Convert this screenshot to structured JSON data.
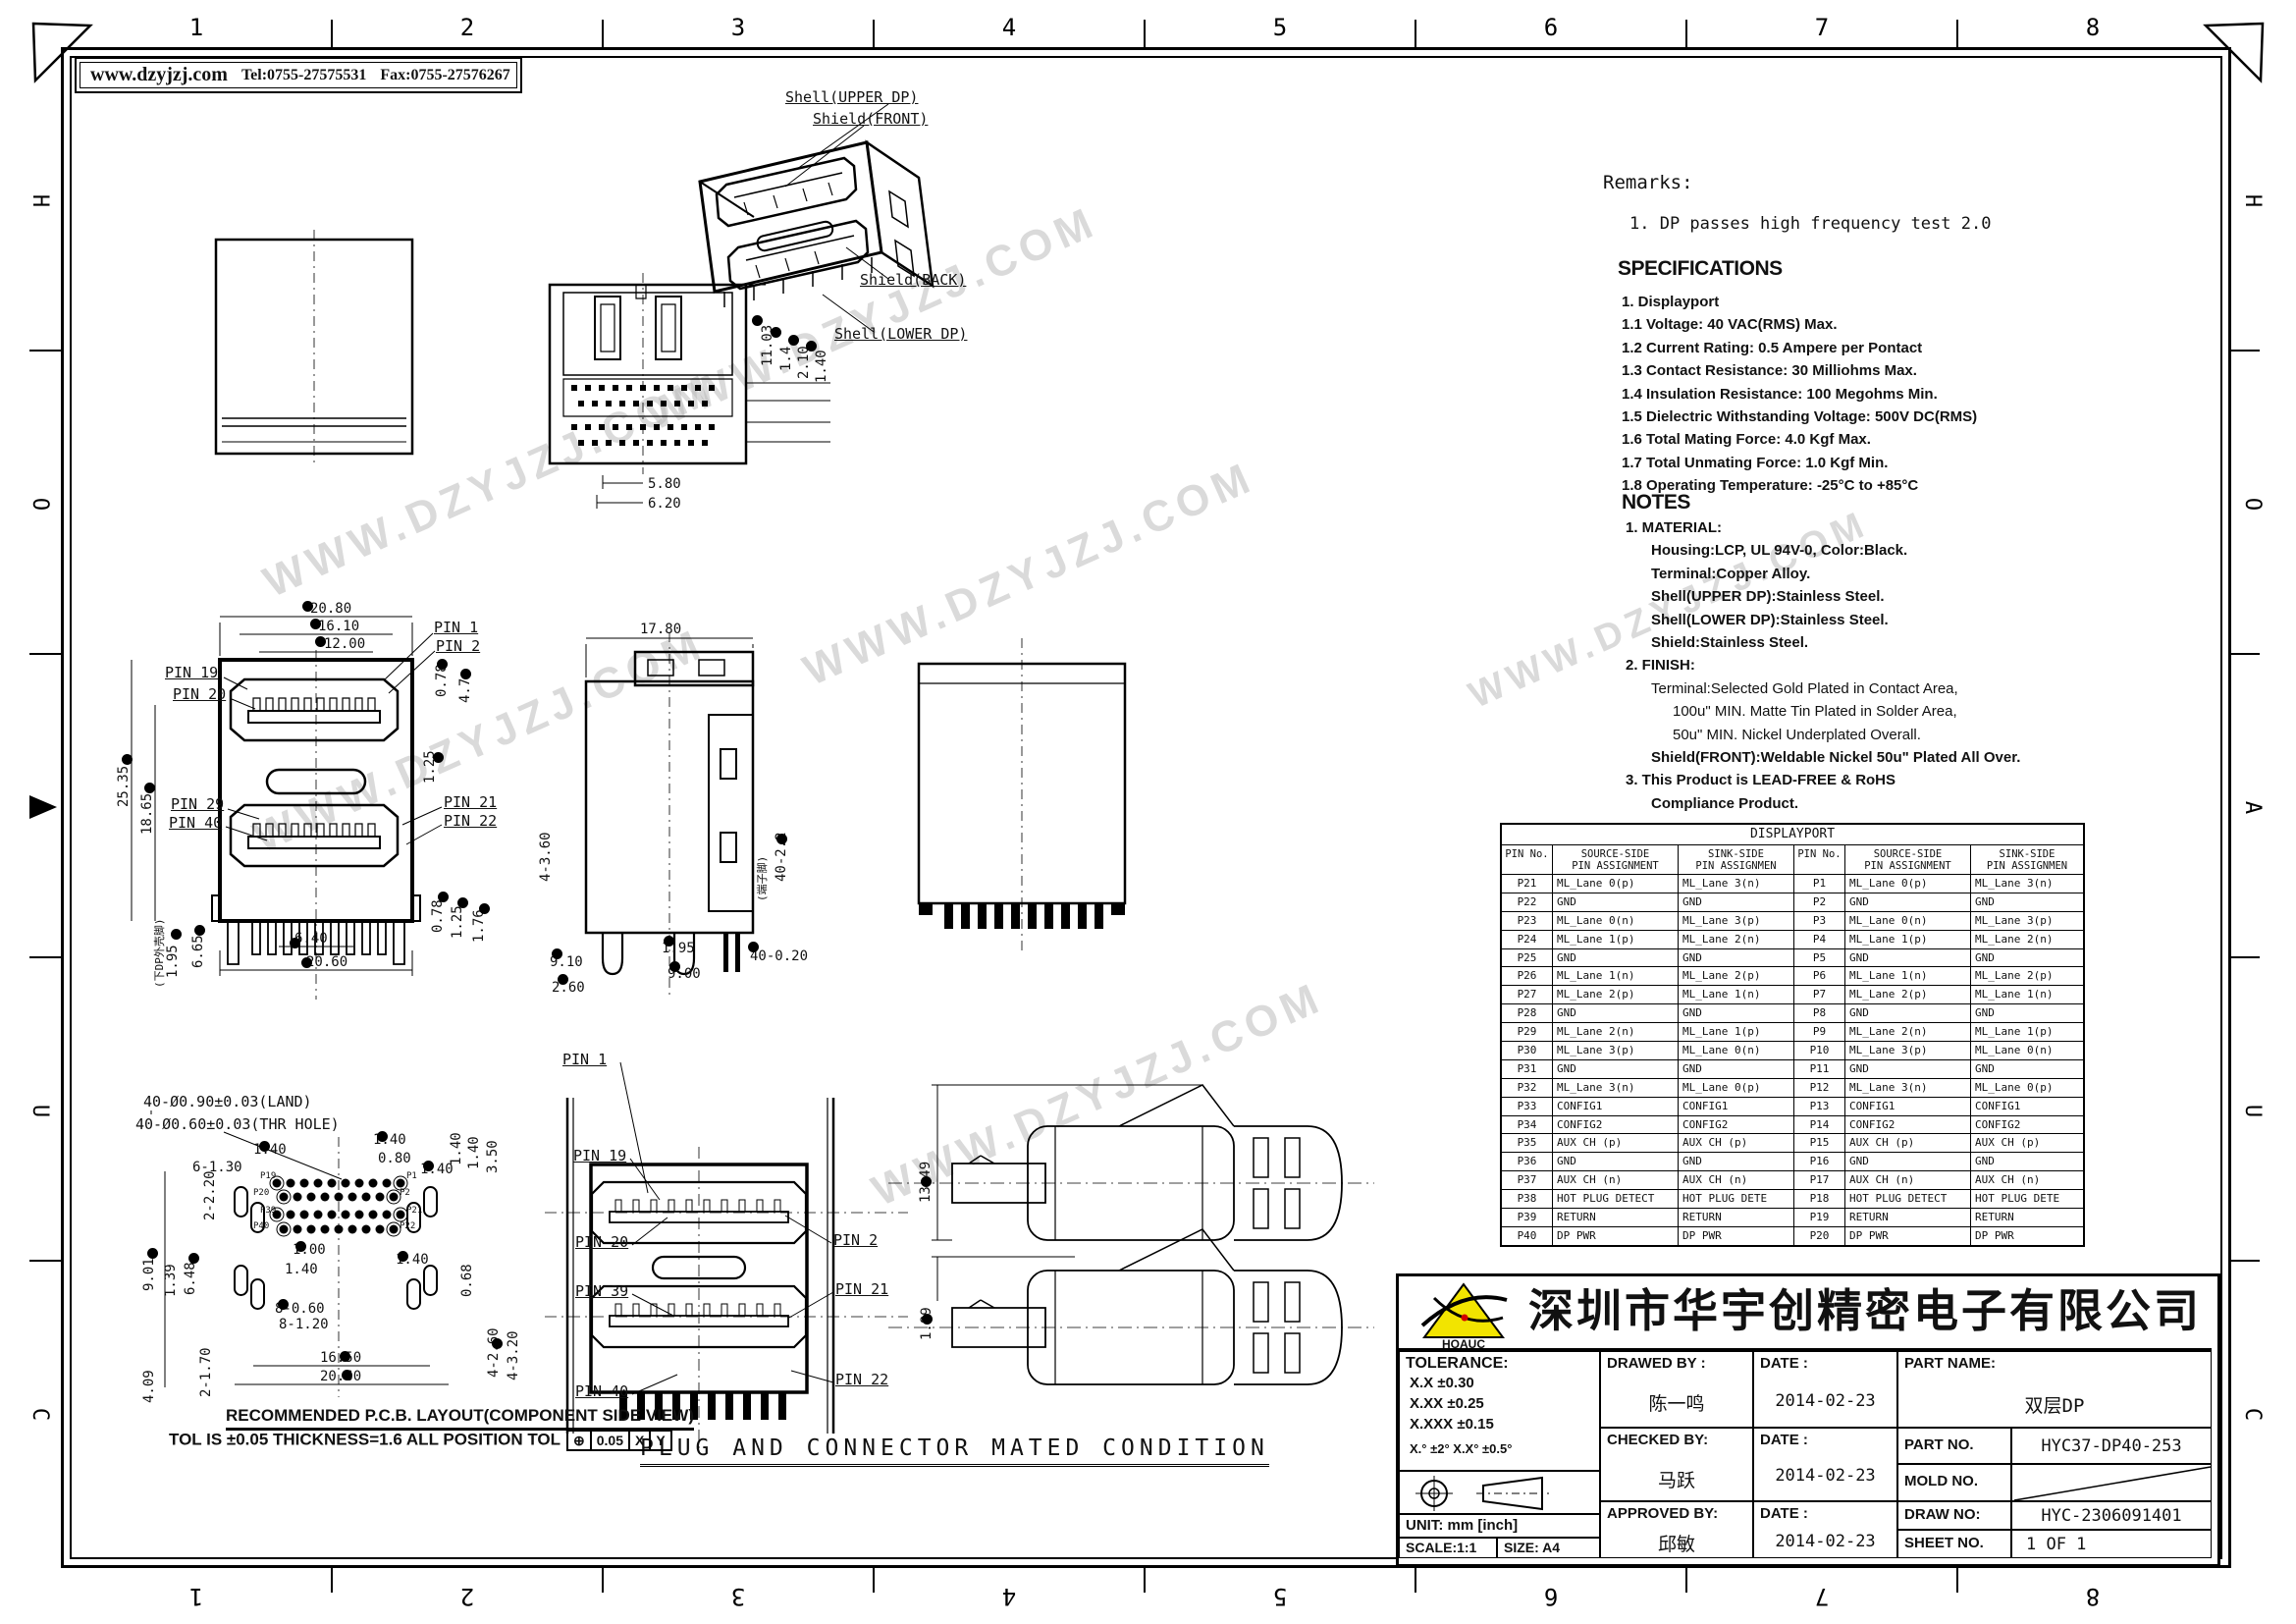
{
  "frame": {
    "cols_top": [
      "1",
      "2",
      "3",
      "4",
      "5",
      "6",
      "7",
      "8"
    ],
    "cols_bottom": [
      "8",
      "7",
      "6",
      "5",
      "4",
      "3",
      "2",
      "1"
    ],
    "rows_left": [
      "H",
      "O",
      "A",
      "U",
      "C"
    ],
    "rows_right": [
      "H",
      "O",
      "A",
      "U",
      "C"
    ]
  },
  "header": {
    "website": "www.dzyjzj.com",
    "tel": "Tel:0755-27575531",
    "fax": "Fax:0755-27576267"
  },
  "watermark": {
    "text": "WWW.DZYJZJ.COM"
  },
  "remarks": {
    "title": "Remarks:",
    "item1": "1. DP passes high frequency test 2.0"
  },
  "specifications": {
    "title": "SPECIFICATIONS",
    "items": [
      "1. Displayport",
      "1.1 Voltage: 40 VAC(RMS) Max.",
      "1.2 Current Rating: 0.5 Ampere per Pontact",
      "1.3 Contact Resistance: 30 Milliohms Max.",
      "1.4 Insulation Resistance: 100 Megohms Min.",
      "1.5 Dielectric Withstanding Voltage: 500V DC(RMS)",
      "1.6 Total Mating Force: 4.0 Kgf Max.",
      "1.7 Total Unmating Force: 1.0 Kgf Min.",
      "1.8 Operating Temperature: -25°C to +85°C"
    ]
  },
  "notes": {
    "title": "NOTES",
    "items": [
      "1. MATERIAL:",
      "Housing:LCP, UL 94V-0, Color:Black.",
      "Terminal:Copper Alloy.",
      "Shell(UPPER DP):Stainless Steel.",
      "Shell(LOWER DP):Stainless Steel.",
      "Shield:Stainless Steel.",
      "2. FINISH:",
      "Terminal:Selected Gold Plated in Contact Area,",
      "100u\" MIN. Matte Tin Plated in Solder Area,",
      "50u\" MIN. Nickel Underplated Overall.",
      "Shield(FRONT):Weldable Nickel 50u\" Plated All Over.",
      "3. This Product is LEAD-FREE & RoHS",
      "Compliance Product."
    ]
  },
  "iso": {
    "shell_upper": "Shell(UPPER DP)",
    "shield_front": "Shield(FRONT)",
    "shield_back": "Shield(BACK)",
    "shell_lower": "Shell(LOWER DP)"
  },
  "front": {
    "d2080": "20.80",
    "d1610": "16.10",
    "d1200": "12.00",
    "d2535": "25.35",
    "d1865": "18.65",
    "d078t": "0.78",
    "d47": "4.7",
    "d125t": "1.25",
    "d195": "1.95",
    "d665": "6.65",
    "d640": "6.40",
    "d2060": "20.60",
    "d078b": "0.78",
    "d125b": "1.25",
    "d176": "1.76",
    "shell_note": "(下DP外壳脚)",
    "pin1": "PIN 1",
    "pin2": "PIN 2",
    "pin19": "PIN 19",
    "pin20": "PIN 20",
    "pin21": "PIN 21",
    "pin22": "PIN 22",
    "pin29": "PIN 29",
    "pin40": "PIN 40"
  },
  "top": {
    "d580": "5.80",
    "d620": "6.20",
    "d1103": "11.03",
    "d14": "1.4",
    "d210": "2.10",
    "d140": "1.40"
  },
  "side": {
    "d1780": "17.80",
    "d4360": "4-3.60",
    "d195": "1.95",
    "d900": "9.00",
    "d910": "9.10",
    "d260": "2.60",
    "d40020": "40-0.20",
    "d4022": "40-2.2",
    "terminal_note": "(端子脚)"
  },
  "pcb": {
    "land": "40-Ø0.90±0.03(LAND)",
    "thr": "40-Ø0.60±0.03(THR HOLE)",
    "d140a": "1.40",
    "d140b": "1.40",
    "d080": "0.80",
    "d140c": "1.40",
    "d140d": "1.40",
    "d140e": "1.40",
    "d350": "3.50",
    "d2220": "2-2.20",
    "d6130": "6-1.30",
    "d901": "9.01",
    "d139": "1.39",
    "d648": "6.48",
    "d100": "1.00",
    "d140f": "1.40",
    "d140g": "1.40",
    "d068": "0.68",
    "d8060": "8-0.60",
    "d8120": "8-1.20",
    "d2170": "2-1.70",
    "d1650": "16.50",
    "d2060": "20.60",
    "d409": "4.09",
    "d4260": "4-2.60",
    "d4320": "4-3.20",
    "p19": "P19",
    "p20": "P20",
    "p39": "P39",
    "p40": "P40",
    "p1": "P1",
    "p2": "P2",
    "p21": "P21",
    "p22": "P22",
    "caption1": "RECOMMENDED P.C.B. LAYOUT(COMPONENT SIDE VIEW)",
    "caption2": "TOL IS ±0.05 THICKNESS=1.6 ALL POSITION TOL",
    "fcf_sym": "⊕",
    "fcf_val": "0.05",
    "fcf_x": "X",
    "fcf_y": "Y"
  },
  "mated": {
    "pin1": "PIN 1",
    "pin19": "PIN 19",
    "pin20": "PIN 20",
    "pin39": "PIN 39",
    "pin40": "PIN 40",
    "pin2": "PIN 2",
    "pin21": "PIN 21",
    "pin22": "PIN 22",
    "d1349": "13.49",
    "d189": "1.89",
    "caption": "PLUG AND CONNECTOR MATED CONDITION"
  },
  "table": {
    "title": "DISPLAYPORT",
    "col_headers": [
      [
        "PIN No.",
        ""
      ],
      [
        "SOURCE-SIDE",
        "PIN ASSIGNMENT"
      ],
      [
        "SINK-SIDE",
        "PIN ASSIGNMEN"
      ],
      [
        "PIN No.",
        ""
      ],
      [
        "SOURCE-SIDE",
        "PIN ASSIGNMENT"
      ],
      [
        "SINK-SIDE",
        "PIN ASSIGNMEN"
      ]
    ],
    "rows": [
      [
        "P21",
        "ML_Lane 0(p)",
        "ML_Lane 3(n)",
        "P1",
        "ML_Lane 0(p)",
        "ML_Lane 3(n)"
      ],
      [
        "P22",
        "GND",
        "GND",
        "P2",
        "GND",
        "GND"
      ],
      [
        "P23",
        "ML_Lane 0(n)",
        "ML_Lane 3(p)",
        "P3",
        "ML_Lane 0(n)",
        "ML_Lane 3(p)"
      ],
      [
        "P24",
        "ML_Lane 1(p)",
        "ML_Lane 2(n)",
        "P4",
        "ML_Lane 1(p)",
        "ML_Lane 2(n)"
      ],
      [
        "P25",
        "GND",
        "GND",
        "P5",
        "GND",
        "GND"
      ],
      [
        "P26",
        "ML_Lane 1(n)",
        "ML_Lane 2(p)",
        "P6",
        "ML_Lane 1(n)",
        "ML_Lane 2(p)"
      ],
      [
        "P27",
        "ML_Lane 2(p)",
        "ML_Lane 1(n)",
        "P7",
        "ML_Lane 2(p)",
        "ML_Lane 1(n)"
      ],
      [
        "P28",
        "GND",
        "GND",
        "P8",
        "GND",
        "GND"
      ],
      [
        "P29",
        "ML_Lane 2(n)",
        "ML_Lane 1(p)",
        "P9",
        "ML_Lane 2(n)",
        "ML_Lane 1(p)"
      ],
      [
        "P30",
        "ML_Lane 3(p)",
        "ML_Lane 0(n)",
        "P10",
        "ML_Lane 3(p)",
        "ML_Lane 0(n)"
      ],
      [
        "P31",
        "GND",
        "GND",
        "P11",
        "GND",
        "GND"
      ],
      [
        "P32",
        "ML_Lane 3(n)",
        "ML_Lane 0(p)",
        "P12",
        "ML_Lane 3(n)",
        "ML_Lane 0(p)"
      ],
      [
        "P33",
        "CONFIG1",
        "CONFIG1",
        "P13",
        "CONFIG1",
        "CONFIG1"
      ],
      [
        "P34",
        "CONFIG2",
        "CONFIG2",
        "P14",
        "CONFIG2",
        "CONFIG2"
      ],
      [
        "P35",
        "AUX CH (p)",
        "AUX CH (p)",
        "P15",
        "AUX CH (p)",
        "AUX CH (p)"
      ],
      [
        "P36",
        "GND",
        "GND",
        "P16",
        "GND",
        "GND"
      ],
      [
        "P37",
        "AUX CH (n)",
        "AUX CH (n)",
        "P17",
        "AUX CH (n)",
        "AUX CH (n)"
      ],
      [
        "P38",
        "HOT PLUG DETECT",
        "HOT PLUG DETE",
        "P18",
        "HOT PLUG DETECT",
        "HOT PLUG DETE"
      ],
      [
        "P39",
        "RETURN",
        "RETURN",
        "P19",
        "RETURN",
        "RETURN"
      ],
      [
        "P40",
        "DP PWR",
        "DP PWR",
        "P20",
        "DP PWR",
        "DP PWR"
      ]
    ]
  },
  "titleblock": {
    "company": "深圳市华宇创精密电子有限公司",
    "logo_text": "HOAUC",
    "tolerance_title": "TOLERANCE:",
    "tol1": "X.X    ±0.30",
    "tol2": "X.XX   ±0.25",
    "tol3": "X.XXX  ±0.15",
    "tol_ang": "X.° ±2°     X.X° ±0.5°",
    "unit": "UNIT:  mm  [inch]",
    "scale": "SCALE:1:1",
    "size": "SIZE:  A4",
    "drawed_label": "DRAWED BY :",
    "drawed_name": "陈一鸣",
    "checked_label": "CHECKED BY:",
    "checked_name": "马跃",
    "approved_label": "APPROVED BY:",
    "approved_name": "邱敏",
    "date_label": "DATE :",
    "date1": "2014-02-23",
    "date2": "2014-02-23",
    "date3": "2014-02-23",
    "part_name_label": "PART NAME:",
    "part_name": "双层DP",
    "part_no_label": "PART NO.",
    "part_no": "HYC37-DP40-253",
    "mold_no_label": "MOLD NO.",
    "draw_no_label": "DRAW NO:",
    "draw_no": "HYC-2306091401",
    "sheet_no_label": "SHEET NO.",
    "sheet_no": "1 OF 1"
  }
}
